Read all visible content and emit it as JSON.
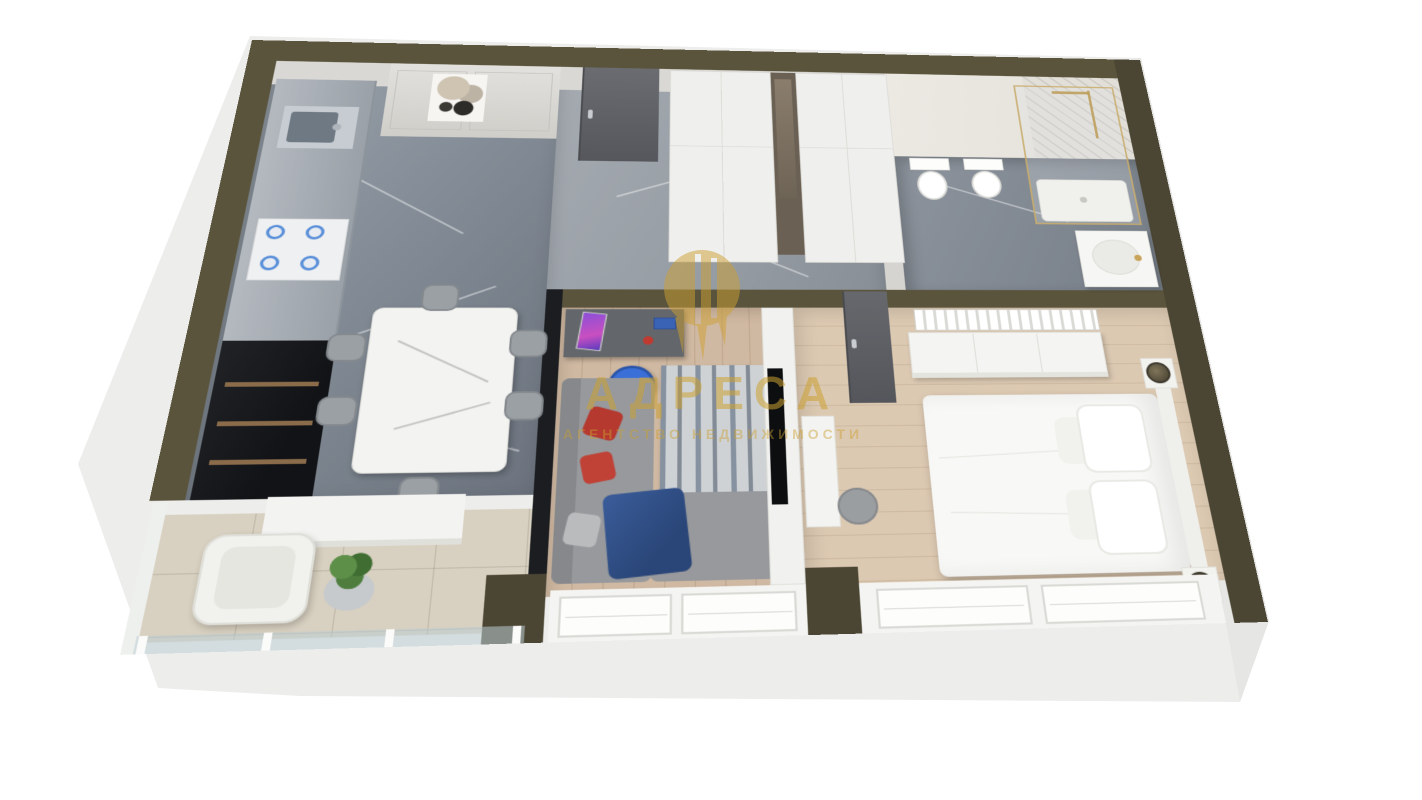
{
  "watermark": {
    "title": "АДРЕСА",
    "subtitle": "АГЕНТСТВО НЕДВИЖИМОСТИ",
    "logo_icon": "adresa-gold-drop-logo"
  },
  "palette": {
    "wall_olive": "#5a543c",
    "wall_olive_dark": "#4b4533",
    "slab": "#edeeec",
    "kitchen_floor": "#87909a",
    "hall_floor": "#9aa1a8",
    "bath_floor": "#848d96",
    "living_floor": "#d0b9a2",
    "bedroom_floor": "#dcc9b2",
    "balcony_floor": "#d8d0c0",
    "black_unit": "#1b1d20",
    "door_gray": "#5f6166",
    "sofa_gray": "#97999c",
    "pillow_red": "#b5392f",
    "throw_blue": "#32528c",
    "chair_blue": "#3a6fd8",
    "burner_blue": "#5a8fd9",
    "watermark_gold": "#cda032"
  }
}
